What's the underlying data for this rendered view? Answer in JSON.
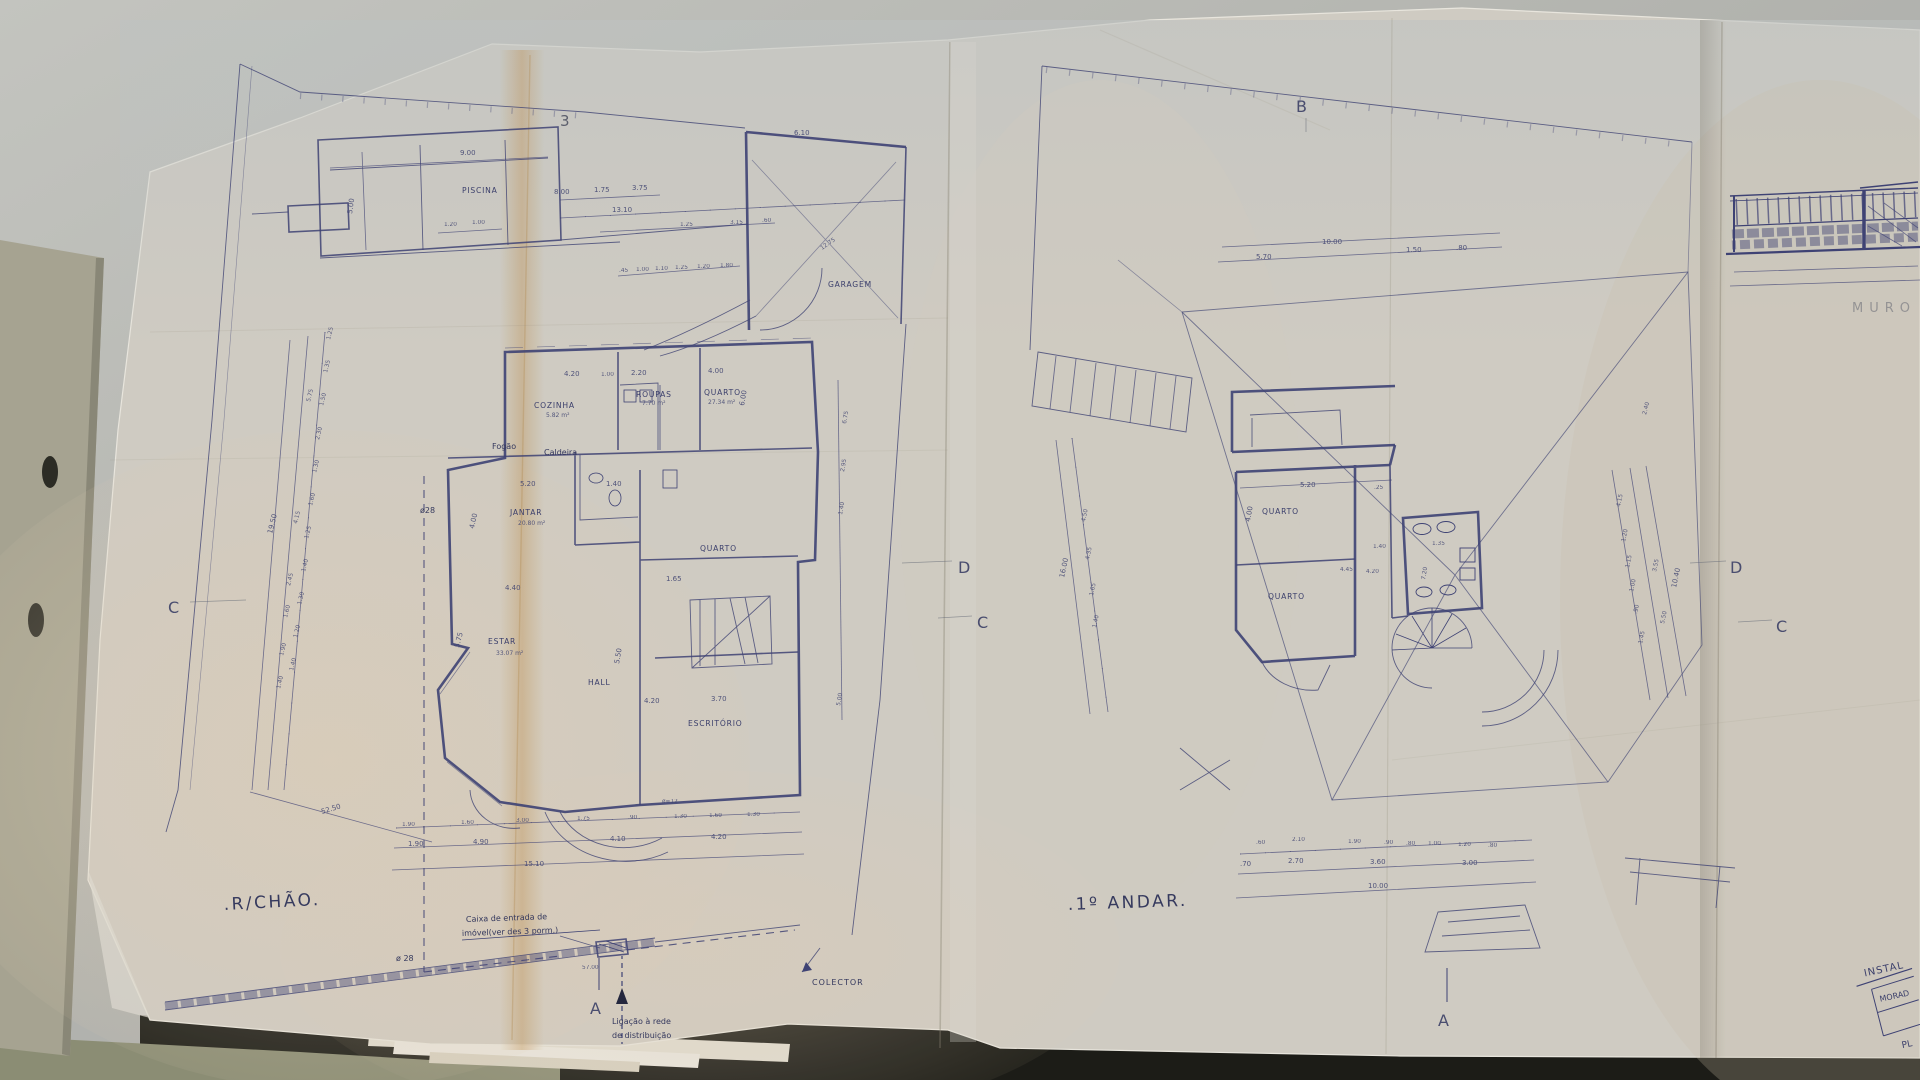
{
  "scene": {
    "desk": "#c2c3bf",
    "paper": "#d5d1c8",
    "ink": "#3e4277",
    "stain": "#c08a42",
    "folder": "#8e9077"
  },
  "ground": {
    "title": ".R/CHÃO.",
    "sheet_no": "3",
    "piscina": "PISCINA",
    "garagem": "GARAGEM",
    "rooms": {
      "cozinha": "COZINHA",
      "cozinha_area": "5.82 m²",
      "roupas": "ROUPAS",
      "roupas_area": "7.70 m²",
      "quarto1": "QUARTO",
      "quarto1_area": "27.34 m²",
      "jantar": "JANTAR",
      "jantar_area": "20.80 m²",
      "estar": "ESTAR",
      "estar_area": "33.07 m²",
      "hall": "HALL",
      "quarto2": "QUARTO",
      "escritorio": "ESCRITÓRIO"
    },
    "annot": {
      "fogao": "Fogão",
      "caldeira": "Caldeira",
      "phi28a": "ø28",
      "phi28b": "ø 28",
      "phi12": "ø=12",
      "caixa1": "Caixa de entrada de",
      "caixa2": "imóvel(ver des 3 porm.)",
      "liga1": "Ligação à rede",
      "liga2": "de distribuição",
      "colector": "COLECTOR",
      "d57": "57.00"
    },
    "dims": {
      "pool_w": "9.00",
      "pool_h": "5.00",
      "pool_a": "1.20",
      "pool_b": "1.00",
      "site_a": "13.10",
      "site_b": "8.00",
      "site_c": "1.75",
      "site_d": "3.75",
      "site_e": "1.25",
      "site_f": "3.15",
      "site_g": ".60",
      "site_row3": [
        ".45",
        "1.00",
        "1.10",
        "1.25",
        "1.20",
        "1.80"
      ],
      "garage_w": "6.10",
      "garage_diag": "12.75",
      "left_inner": [
        "1.25",
        "1.35",
        "1.50",
        "2.30",
        "1.30",
        "1.60",
        "1.25",
        "1.40",
        "1.30",
        "1.20",
        "1.40"
      ],
      "left_mid": [
        "5.75",
        "4.15",
        "2.45",
        "1.60",
        "1.90",
        "1.40"
      ],
      "left_outer": "19.50",
      "left_total": "52.50",
      "top_a": "4.20",
      "top_b": "1.00",
      "top_c": "2.20",
      "top_d": "4.00",
      "right_h": "6.00",
      "jantar_w": "5.20",
      "jantar_a": "1.40",
      "jantar_h": "4.00",
      "jantar_b": "4.40",
      "jantar_c": "1.65",
      "estar_h": "5.75",
      "hall_h": "5.50",
      "hall_a": "4.20",
      "hall_b": "3.70",
      "right_chain": [
        "6.75",
        "2.95",
        "1.40",
        "5.00"
      ],
      "bot1": [
        "1.90",
        "1.60",
        "3.00",
        "1.75",
        ".90",
        "1.30",
        "1.60",
        "1.30"
      ],
      "bot2": [
        "1.90",
        "4.90",
        "4.10",
        "4.20"
      ],
      "bot3": "15.10"
    }
  },
  "first": {
    "title": ".1º ANDAR.",
    "rooms": {
      "quarto1": "QUARTO",
      "quarto2": "QUARTO"
    },
    "dims": {
      "top_total": "10.00",
      "top_a": "5.70",
      "top_b": "1.50",
      "top_c": ".80",
      "q_w": "5.20",
      "q_off": ".25",
      "q_h": "4.00",
      "mid_a": "1.40",
      "mid_b": "1.35",
      "mid_c": "4.45",
      "mid_d": "4.20",
      "mid_e": "7.20",
      "left_chain": [
        "4.50",
        "4.35",
        "1.65",
        "1.40"
      ],
      "left_total": "16.00",
      "right_chain": [
        "4.15",
        "1.20",
        "1.15",
        "1.00",
        ".90",
        "1.45"
      ],
      "right_mid": "3.55",
      "right_out_a": "5.50",
      "right_out_b": "10.40",
      "tr": "2.40",
      "bot1": [
        ".60",
        "2.10",
        "1.90",
        ".90",
        ".80",
        "1.00",
        "1.20",
        ".80"
      ],
      "bot2": [
        ".70",
        "2.70",
        "3.60",
        "3.00"
      ],
      "bot3": "10.00"
    }
  },
  "markers": {
    "a": "A",
    "b": "B",
    "c": "C",
    "d": "D"
  },
  "side": {
    "muro": "MURO",
    "tb1": "INSTAL",
    "tb2": "MORAD",
    "tb3": "PL"
  }
}
